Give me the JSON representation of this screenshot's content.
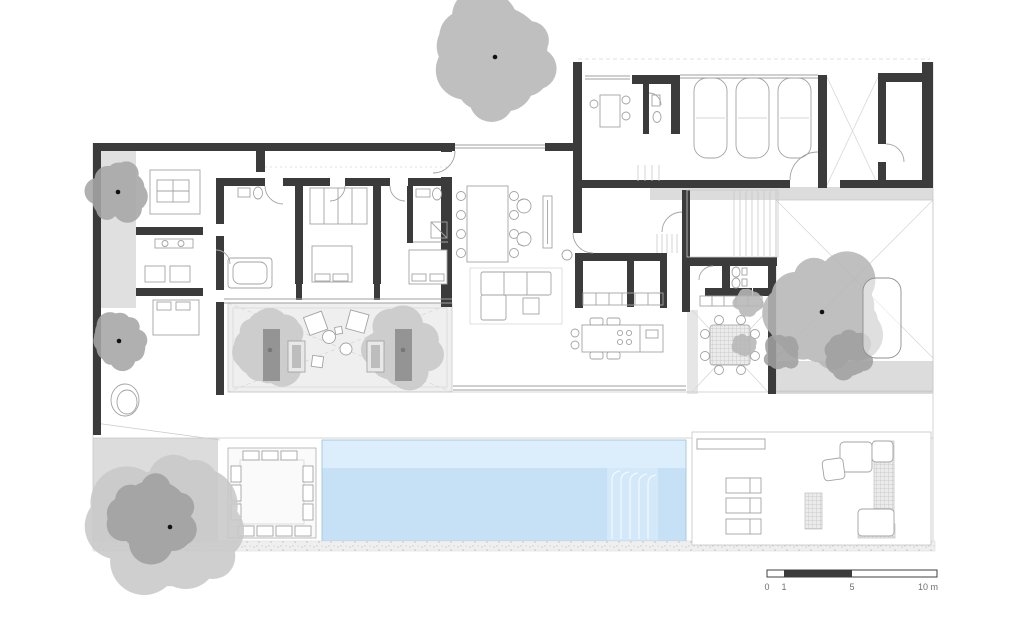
{
  "plan": {
    "kind": "architectural-floor-plan",
    "background": "#ffffff"
  },
  "colors": {
    "wall": "#3b3b3b",
    "furniture_line": "#a3a3a3",
    "terrace_gray": "#dcdcdc",
    "patio_gray": "#efefef",
    "pool_shallow": "#dceefb",
    "pool_main": "#c6e0f5",
    "pool_steps": "#d3e8f8",
    "pool_edge": "#aac8e0",
    "tree_light": "#c9c9c9",
    "tree_mid": "#b7b7b7",
    "tree_mid2": "#a6a6a6",
    "tree_dark": "#a0a0a0",
    "dark_furniture": "#8a8a8a",
    "gravel": "#efefef"
  },
  "scale_bar": {
    "labels": [
      "0",
      "1",
      "5",
      "10 m"
    ],
    "bar": {
      "x": 767,
      "y": 570,
      "width": 170,
      "height": 7,
      "dark_from": 784,
      "dark_to": 852
    }
  },
  "trees": [
    {
      "id": "tree-top",
      "cx": 495,
      "cy": 57,
      "r": 66,
      "tone": "mid",
      "dot": true,
      "seed": 11
    },
    {
      "id": "tree-left-upper",
      "cx": 118,
      "cy": 192,
      "r": 31,
      "tone": "mid2",
      "dot": true,
      "seed": 23
    },
    {
      "id": "tree-left-mid",
      "cx": 119,
      "cy": 341,
      "r": 28,
      "tone": "mid2",
      "dot": true,
      "seed": 37
    },
    {
      "id": "tree-garden-left",
      "cx": 170,
      "cy": 527,
      "r": 76,
      "tone": "light",
      "dot": true,
      "seed": 41,
      "spots": [
        {
          "dx": -16,
          "dy": -10,
          "r": 47
        }
      ]
    },
    {
      "id": "tree-patio-west",
      "cx": 270,
      "cy": 350,
      "r": 41,
      "tone": "light",
      "dot": true,
      "seed": 53
    },
    {
      "id": "tree-patio-east",
      "cx": 403,
      "cy": 350,
      "r": 41,
      "tone": "light",
      "dot": true,
      "seed": 67
    },
    {
      "id": "tree-terrace-east",
      "cx": 822,
      "cy": 312,
      "r": 62,
      "tone": "mid",
      "dot": true,
      "seed": 73,
      "spots": [
        {
          "dx": 26,
          "dy": 44,
          "r": 26
        },
        {
          "dx": -40,
          "dy": 40,
          "r": 20
        }
      ]
    },
    {
      "id": "tree-scatter-1",
      "cx": 748,
      "cy": 302,
      "r": 15,
      "tone": "mid",
      "dot": false,
      "seed": 83
    },
    {
      "id": "tree-scatter-2",
      "cx": 744,
      "cy": 345,
      "r": 12,
      "tone": "mid",
      "dot": false,
      "seed": 97
    }
  ]
}
